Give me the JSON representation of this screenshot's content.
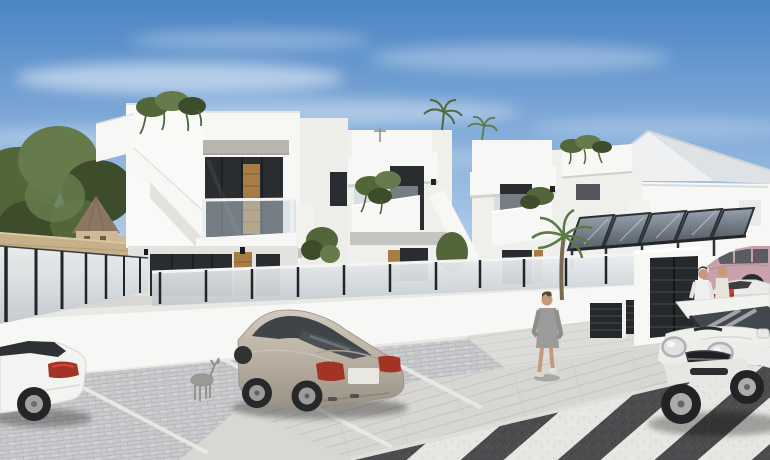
{
  "meta": {
    "type": "architectural-render-photo",
    "description": "New-build white Mediterranean townhouses with roof terraces, glass balustrades and carports; cobbled parking bays with three cars, pedestrians on the sidewalk and a zebra crossing on the asphalt road.",
    "width_px": 770,
    "height_px": 460
  },
  "scene": {
    "sky": {
      "label": "blue sky with wispy clouds"
    },
    "background": {
      "trees_label": "green pine trees",
      "distant_house_label": "beige house with conical roof",
      "boundary_wall_label": "tan stone boundary wall"
    },
    "buildings": {
      "townhouse_row_label": "row of white two-storey townhouses",
      "unit1_label": "corner townhouse with external staircase and wood-clad doorway",
      "unit2_label": "townhouse with planted balcony",
      "unit3_label": "townhouse with planted balcony and palm",
      "unit4_label": "end townhouse with roof-terrace planting",
      "gable_house_label": "white gable-roofed house",
      "canopies_label": "glass carport canopies",
      "garage_label": "anthracite louvred garage doors",
      "fence_label": "frosted glass fence with dark posts",
      "balcony_label": "glass balustrade balcony",
      "roof_plants_label": "hanging roof-terrace plants"
    },
    "street": {
      "parking_label": "cobblestone parking bays with white markings",
      "sidewalk_label": "light paved sidewalk",
      "road_label": "asphalt road",
      "crossing_label": "zebra crossing",
      "ornament_label": "deer garden ornament"
    },
    "vehicles": [
      {
        "label": "white sports coupe, rear view",
        "color": "#f3f3f1"
      },
      {
        "label": "champagne-silver sedan parked in bay",
        "color": "#bcb3a7"
      },
      {
        "label": "white Mini hatchback on road",
        "color": "#f2f2f0"
      },
      {
        "label": "pink sedan in driveway",
        "color": "#c7a2ac"
      },
      {
        "label": "white sedan with open trunk and red luggage",
        "color": "#ebebe9"
      }
    ],
    "people": [
      {
        "label": "woman in grey dress walking on sidewalk"
      },
      {
        "label": "man in white shirt by parked cars"
      },
      {
        "label": "blonde woman with red bag"
      }
    ],
    "palette": {
      "skyTop": "#4b84c4",
      "skyMid": "#7fa9d8",
      "skyHorizon": "#d9e7f3",
      "wallBright": "#f7f7f5",
      "wallLight": "#efefec",
      "wallShade": "#e2e2df",
      "wallShadow": "#c4c4c1",
      "glassDark": "#2a2d30",
      "wood": "#a87d45",
      "frostTop": "#eceff1",
      "frostBottom": "#c3c9cd",
      "fencePost": "#232528",
      "tanWall": "#c6b08a",
      "treeDark": "#3d4d2c",
      "treeMid": "#53663a",
      "treeLight": "#667b4b",
      "cobble": "#cbccce",
      "sidewalk": "#d8d6d2",
      "asphalt": "#4a4c4e",
      "zebra": "#e8e6e2",
      "lineWhite": "#eceae6",
      "tailRed": "#a33325",
      "bagRed": "#a8352c",
      "skin": "#c49a7c",
      "dressGrey": "#9b9b99"
    }
  }
}
